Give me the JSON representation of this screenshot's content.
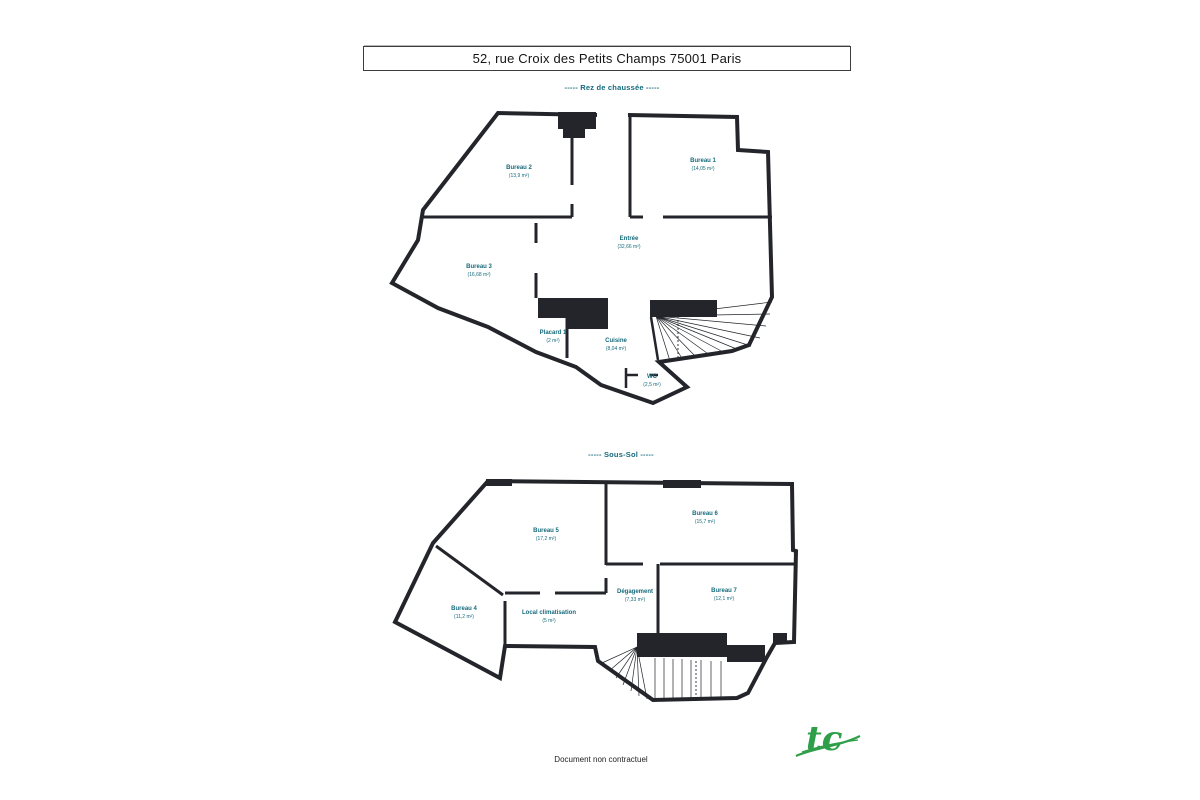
{
  "page": {
    "title": "52, rue Croix des Petits Champs 75001 Paris",
    "footer_note": "Document non contractuel",
    "logo_text": "tc"
  },
  "colors": {
    "wall": "#23252b",
    "room_label": "#156a7c",
    "floor_title": "#156a7c",
    "logo_green": "#2f9e49"
  },
  "floors": [
    {
      "id": "rez-de-chaussee",
      "title": "----- Rez de chaussée -----",
      "rooms": [
        {
          "name": "Bureau 2",
          "area": "(13,9 m²)"
        },
        {
          "name": "Bureau 1",
          "area": "(14,05 m²)"
        },
        {
          "name": "Entrée",
          "area": "(32,66 m²)"
        },
        {
          "name": "Bureau 3",
          "area": "(16,68 m²)"
        },
        {
          "name": "Placard 1",
          "area": "(2 m²)"
        },
        {
          "name": "Cuisine",
          "area": "(8,04 m²)"
        },
        {
          "name": "WC",
          "area": "(2,5 m²)"
        }
      ]
    },
    {
      "id": "sous-sol",
      "title": "----- Sous-Sol -----",
      "rooms": [
        {
          "name": "Bureau 5",
          "area": "(17,2 m²)"
        },
        {
          "name": "Bureau 6",
          "area": "(15,7 m²)"
        },
        {
          "name": "Dégagement",
          "area": "(7,33 m²)"
        },
        {
          "name": "Bureau 7",
          "area": "(12,1 m²)"
        },
        {
          "name": "Bureau 4",
          "area": "(11,2 m²)"
        },
        {
          "name": "Local climatisation",
          "area": "(5 m²)"
        }
      ]
    }
  ]
}
